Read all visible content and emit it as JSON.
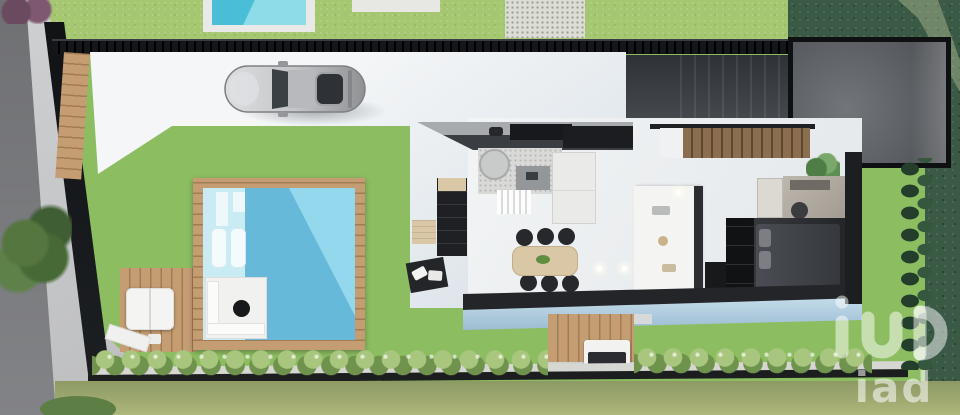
{
  "watermark": {
    "text": "iad",
    "logo": "iad-logo-glyph",
    "opacity": "0.5"
  },
  "palette": {
    "lawn_main": "#8cbd61",
    "lawn_top": "#a6c771",
    "lawn_dark": "#3a5a46",
    "lawn_olive": "#99a56b",
    "road": "#7a7b7e",
    "sidewalk": "#c9cacb",
    "wall": "#16181b",
    "floor_white": "#eff1f2",
    "pool_water": "#93d8ed",
    "pool_shadow": "#5fb4d6",
    "pool_ledge": "#c9ecf4",
    "wood": "#c49d73",
    "roof": "#3f4348",
    "courtyard": "#5b5e62",
    "furniture_black": "#202226",
    "cushion_beige": "#dac7a6",
    "glass_blue": "#b9d6e6",
    "bed_dark": "#44474d",
    "car_silver": "#c3c5c8"
  },
  "scene": {
    "description": "Top-down 3D architectural render of a modern single-storey house plot with garden lawn, swimming pool with wooden deck, terraces, parked silver car on white driveway, walled dark courtyard, interior furniture layout, hedges and neighbouring parcels",
    "objects": [
      "road",
      "sidewalk",
      "boundary-wall",
      "top-fence",
      "neighbor-pool",
      "gravel-path",
      "driveway",
      "silver-car",
      "entry-roof",
      "walled-courtyard",
      "house-interior",
      "kitchen-counter",
      "kitchen-island",
      "staircase",
      "dining-table",
      "dining-chairs",
      "sofa",
      "rug",
      "round-chair",
      "coffee-table",
      "terrace-chaise",
      "outdoor-pouf",
      "swimming-pool",
      "pool-deck",
      "sun-loungers",
      "pool-lounge-platform",
      "bedroom-bed",
      "wardrobe",
      "desk",
      "indoor-plant",
      "glass-canopy",
      "flower-hedge",
      "cypress-hedge",
      "bbq-deck",
      "bbq-grill",
      "bottom-fence",
      "neighbor-lawns",
      "iad-watermark"
    ]
  }
}
